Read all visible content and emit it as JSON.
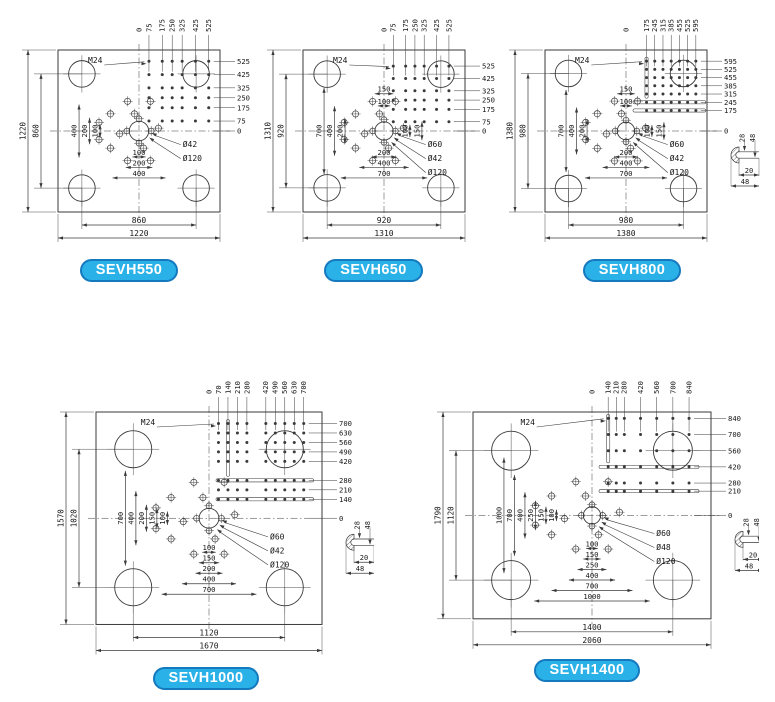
{
  "figure": {
    "title": "Injection molding machine platen dimension drawings",
    "line_color": "#3a3a3a",
    "text_color": "#161616",
    "badge_fill": "#29b1e8",
    "badge_border": "#1579be",
    "badge_text_color": "#ffffff"
  },
  "plates": [
    {
      "model": "SEVH550",
      "thread_label": "M24",
      "top_ticks": [
        "0",
        "75",
        "175",
        "250",
        "325",
        "425",
        "525"
      ],
      "right_ticks": [
        "525",
        "425",
        "325",
        "250",
        "175",
        "75",
        "0"
      ],
      "left_outer_dims": [
        "1220",
        "860"
      ],
      "left_inner_dims": [
        "400",
        "200",
        "100"
      ],
      "top_inner_dims": [],
      "center_vertical_dims": [],
      "bottom_inner_dims": [
        "100",
        "200",
        "400"
      ],
      "bottom_outer_dims": [
        "860",
        "1220"
      ],
      "hole_labels": [
        "Ø42",
        "Ø120"
      ],
      "has_t_slots": false,
      "edge_detail": null
    },
    {
      "model": "SEVH650",
      "thread_label": "M24",
      "top_ticks": [
        "0",
        "75",
        "175",
        "250",
        "325",
        "425",
        "525"
      ],
      "right_ticks": [
        "525",
        "425",
        "325",
        "250",
        "175",
        "75",
        "0"
      ],
      "left_outer_dims": [
        "1310",
        "920"
      ],
      "left_inner_dims": [
        "700",
        "400",
        "200"
      ],
      "top_inner_dims": [
        "150",
        "100"
      ],
      "center_vertical_dims": [
        "100",
        "150"
      ],
      "bottom_inner_dims": [
        "200",
        "400",
        "700"
      ],
      "bottom_outer_dims": [
        "920",
        "1310"
      ],
      "hole_labels": [
        "Ø60",
        "Ø42",
        "Ø120"
      ],
      "has_t_slots": false,
      "edge_detail": null
    },
    {
      "model": "SEVH800",
      "thread_label": "M24",
      "top_ticks": [
        "0",
        "175",
        "245",
        "315",
        "385",
        "455",
        "525",
        "595"
      ],
      "right_ticks": [
        "595",
        "525",
        "455",
        "385",
        "315",
        "245",
        "175",
        "0"
      ],
      "left_outer_dims": [
        "1380",
        "980"
      ],
      "left_inner_dims": [
        "700",
        "400",
        "200"
      ],
      "top_inner_dims": [
        "150",
        "100"
      ],
      "center_vertical_dims": [
        "100",
        "150"
      ],
      "bottom_inner_dims": [
        "200",
        "400",
        "700"
      ],
      "bottom_outer_dims": [
        "980",
        "1380"
      ],
      "hole_labels": [
        "Ø60",
        "Ø42",
        "Ø120"
      ],
      "has_t_slots": true,
      "edge_detail": {
        "top_dims": [
          "28",
          "48"
        ],
        "side_dims": [
          "20",
          "48"
        ]
      }
    },
    {
      "model": "SEVH1000",
      "thread_label": "M24",
      "top_ticks": [
        "0",
        "70",
        "140",
        "210",
        "280",
        "420",
        "490",
        "560",
        "630",
        "700"
      ],
      "right_ticks": [
        "700",
        "630",
        "560",
        "490",
        "420",
        "280",
        "210",
        "140",
        "0"
      ],
      "left_outer_dims": [
        "1570",
        "1020"
      ],
      "left_inner_dims": [
        "700",
        "400",
        "200",
        "150",
        "100"
      ],
      "top_inner_dims": [],
      "center_vertical_dims": [],
      "bottom_inner_dims": [
        "100",
        "150",
        "200",
        "400",
        "700"
      ],
      "bottom_outer_dims": [
        "1120",
        "1670"
      ],
      "hole_labels": [
        "Ø60",
        "Ø42",
        "Ø120"
      ],
      "has_t_slots": true,
      "edge_detail": {
        "top_dims": [
          "28",
          "48"
        ],
        "side_dims": [
          "20",
          "48"
        ]
      }
    },
    {
      "model": "SEVH1400",
      "thread_label": "M24",
      "top_ticks": [
        "0",
        "140",
        "210",
        "280",
        "420",
        "560",
        "700",
        "840"
      ],
      "right_ticks": [
        "840",
        "700",
        "560",
        "420",
        "280",
        "210",
        "0"
      ],
      "left_outer_dims": [
        "1790",
        "1120"
      ],
      "left_inner_dims": [
        "1000",
        "700",
        "400",
        "250",
        "150",
        "100"
      ],
      "top_inner_dims": [],
      "center_vertical_dims": [],
      "bottom_inner_dims": [
        "100",
        "150",
        "250",
        "400",
        "700",
        "1000"
      ],
      "bottom_outer_dims": [
        "1400",
        "2060"
      ],
      "hole_labels": [
        "Ø60",
        "Ø48",
        "Ø120"
      ],
      "has_t_slots": true,
      "edge_detail": {
        "top_dims": [
          "28",
          "48"
        ],
        "side_dims": [
          "20",
          "48"
        ]
      }
    }
  ]
}
